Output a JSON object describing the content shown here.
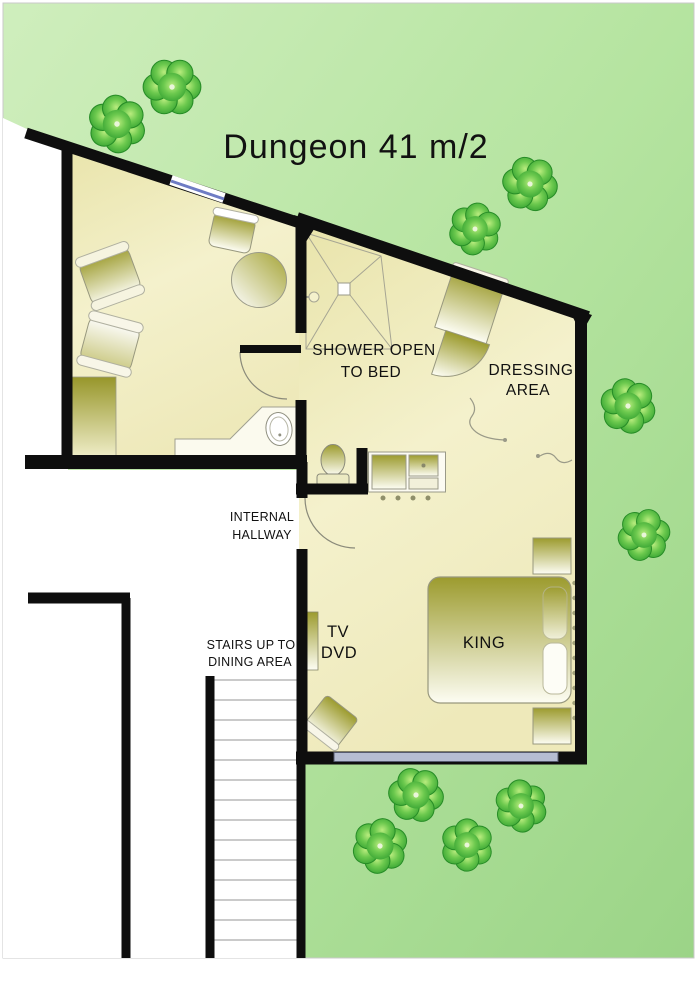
{
  "title": "Dungeon  41 m/2",
  "labels": {
    "shower_line1": "SHOWER OPEN",
    "shower_line2": "TO BED",
    "dressing_line1": "DRESSING",
    "dressing_line2": "AREA",
    "hallway_line1": "INTERNAL",
    "hallway_line2": "HALLWAY",
    "stairs_line1": "STAIRS UP TO",
    "stairs_line2": "DINING AREA",
    "tv_line1": "TV",
    "tv_line2": "DVD",
    "bed": "KING"
  },
  "palette": {
    "garden_green_light": "#cdeebb",
    "garden_green_dark": "#9bd487",
    "tree_green": "#2f9e2f",
    "floor_cream": "#f2efc8",
    "furniture_olive": "#9f9e31",
    "wall_black": "#0e0e0e",
    "window_blue": "#6e7cc4",
    "window_gray": "#b6bdd2"
  }
}
